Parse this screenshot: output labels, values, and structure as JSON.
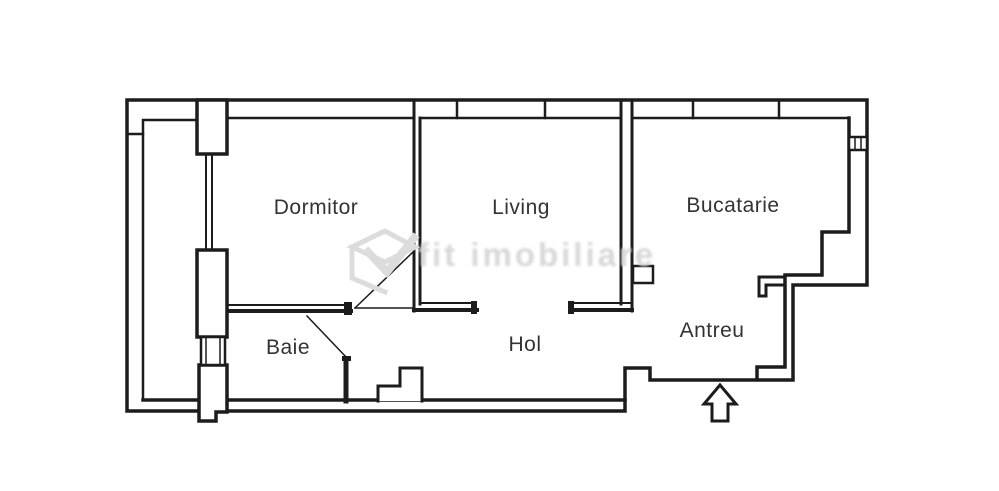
{
  "rooms": {
    "dormitor": {
      "label": "Dormitor"
    },
    "living": {
      "label": "Living"
    },
    "bucatarie": {
      "label": "Bucatarie"
    },
    "baie": {
      "label": "Baie"
    },
    "hol": {
      "label": "Hol"
    },
    "antreu": {
      "label": "Antreu"
    }
  },
  "watermark": {
    "text": "fit imobiliare"
  },
  "icons": {
    "entrance_arrow": "up-arrow-outline"
  },
  "colors": {
    "wall": "#1c1c1c",
    "label_text": "#333333",
    "watermark": "#d8d8d8",
    "background": "#ffffff"
  }
}
